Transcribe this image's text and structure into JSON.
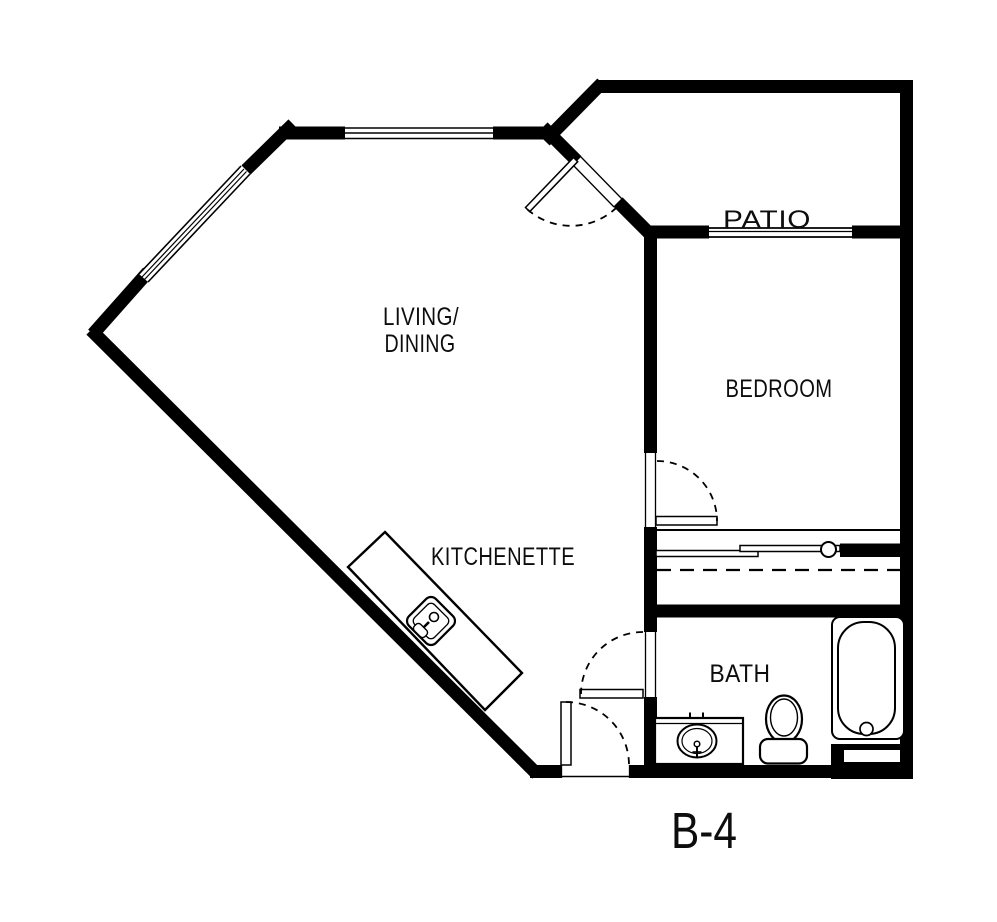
{
  "document": {
    "type": "architectural-floor-plan",
    "unit": {
      "label": "B-4"
    }
  },
  "rooms": {
    "living_dining": {
      "line1": "LIVING/",
      "line2": "DINING"
    },
    "patio": {
      "label": "PATIO"
    },
    "bedroom": {
      "label": "BEDROOM"
    },
    "kitchenette": {
      "label": "KITCHENETTE"
    },
    "bath": {
      "label": "BATH"
    }
  },
  "fixtures": {
    "bathtub": "bathtub-with-drain",
    "toilet": "toilet-with-tank",
    "vanity_sink": "bathroom-vanity-oval-sink-with-faucet",
    "kitchen_sink": "kitchenette-square-sink-with-faucet",
    "counter": "kitchenette-counter",
    "closet_rod": "closet-rod-dashed",
    "closet_doors": "bypass-sliding-closet-doors"
  },
  "doors": {
    "patio_door": "hinged-door-swing-into-living",
    "bedroom_door": "hinged-door-swing-into-bedroom",
    "bath_door": "hinged-door-swing-out-of-bath",
    "entry_door": "hinged-entry-door-swing-inward"
  },
  "windows": {
    "diagonal_window": "window-in-northwest-diagonal-wall",
    "top_window": "window-in-living-north-wall",
    "bedroom_window": "window-between-patio-and-bedroom"
  },
  "colors": {
    "wall": "#000000",
    "background": "#ffffff",
    "line": "#000000",
    "text": "#0d0d0d"
  }
}
